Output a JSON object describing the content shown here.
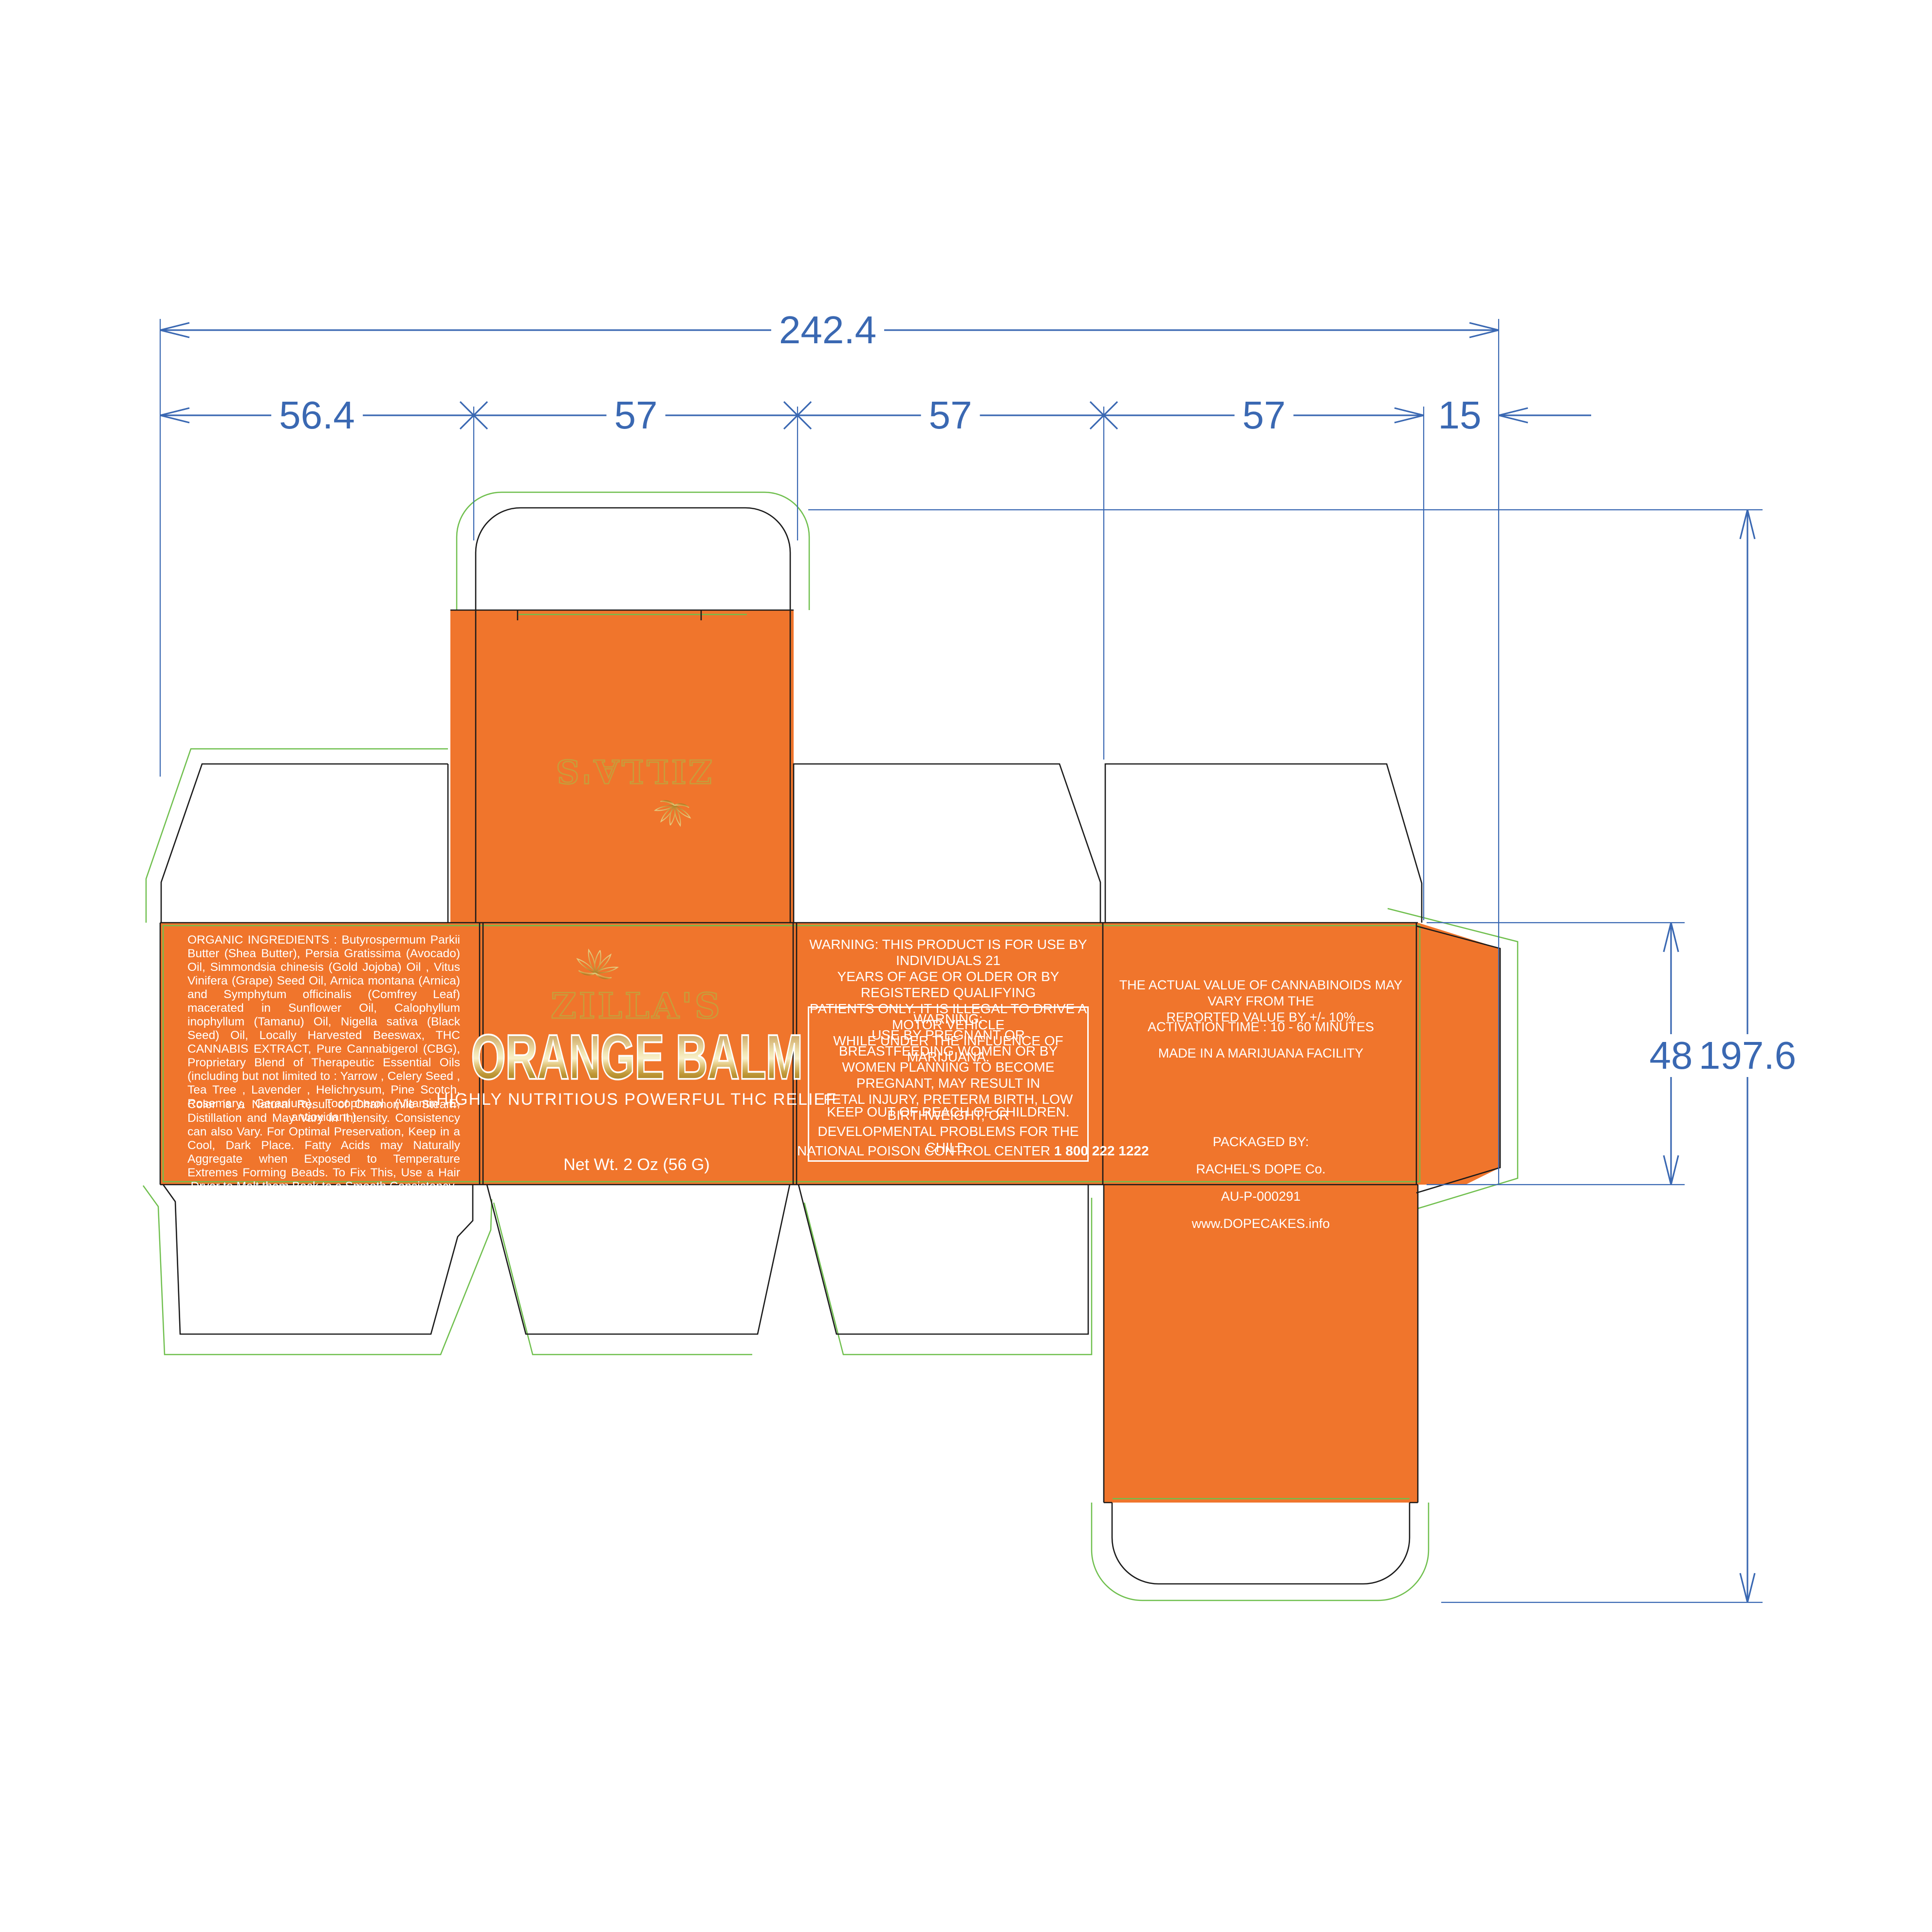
{
  "dimensions": {
    "total_width": "242.4",
    "segments": [
      "56.4",
      "57",
      "57",
      "57",
      "15"
    ],
    "side_height": "48",
    "total_height": "197.6"
  },
  "top_panel": {
    "brand": "ZILLA'S"
  },
  "front_panel": {
    "brand": "ZILLA'S",
    "product": "ORANGE BALM",
    "tagline": "HIGHLY NUTRITIOUS POWERFUL THC RELIEF",
    "net_weight": "Net Wt. 2 Oz (56 G)"
  },
  "ingredients_panel": {
    "ingredients": "ORGANIC INGREDIENTS : Butyrospermum Parkii Butter (Shea Butter), Persia Gratissima (Avocado) Oil, Simmondsia chinesis (Gold Jojoba) Oil , Vitus Vinifera (Grape) Seed Oil, Arnica montana (Arnica) and Symphytum officinalis (Comfrey Leaf) macerated in Sunflower Oil, Calophyllum inophyllum (Tamanu) Oil, Nigella sativa (Black Seed) Oil, Locally Harvested Beeswax, THC CANNABIS EXTRACT, Pure Cannabigerol (CBG), Proprietary Blend of Therapeutic Essential Oils (including but not limited to : Yarrow , Celery Seed , Tea Tree , Lavender , Helichrysum, Pine Scotch, Rosemary, Geranium), Tocopherol (Vitamin E, antioxidant )",
    "storage": "Color is a Natural Result of Chamomile Steam-Distillation and May Vary in Intensity. Consistency can also Vary.  For Optimal Preservation, Keep in a Cool, Dark Place. Fatty Acids may Naturally Aggregate when Exposed to Temperature Extremes Forming Beads. To Fix This, Use a Hair Dryer to Melt them Back to a Smooth Consistency."
  },
  "warning_panel": {
    "age_warning": "WARNING: THIS PRODUCT IS FOR USE BY INDIVIDUALS 21\nYEARS OF AGE OR OLDER OR BY REGISTERED QUALIFYING\nPATIENTS ONLY. IT IS ILLEGAL TO DRIVE A MOTOR VEHICLE\nWHILE UNDER THE INFLUENCE OF MARIJUANA.",
    "boxed_title": "WARNING:",
    "boxed_warning": "USE BY PREGNANT OR BREASTFEEDING WOMEN OR BY\nWOMEN PLANNING TO BECOME PREGNANT, MAY RESULT IN\nFETAL INJURY, PRETERM BIRTH, LOW BIRTHWEIGHT, OR\nDEVELOPMENTAL PROBLEMS FOR THE CHILD.",
    "keep_out": "KEEP OUT OF REACH OF CHILDREN.",
    "poison_label": "NATIONAL POISON CONTROL CENTER ",
    "poison_number": "1 800 222 1222"
  },
  "info_panel": {
    "cannabinoids": "THE  ACTUAL  VALUE  OF  CANNABINOIDS  MAY  VARY  FROM  THE\nREPORTED VALUE BY +/- 10%",
    "activation": "ACTIVATION TIME : 10 - 60 MINUTES",
    "facility": "MADE IN A MARIJUANA FACILITY",
    "packaged_by": "PACKAGED BY:",
    "company": "RACHEL'S DOPE Co.",
    "license": "AU-P-000291",
    "website": "www.DOPECAKES.info"
  },
  "colors": {
    "panel_orange": "#F0752C",
    "gold": "#C79E3B",
    "dieline_black": "#1a1a1a",
    "bleed_green": "#6FBF4D",
    "dimension_blue": "#3A68B2"
  }
}
